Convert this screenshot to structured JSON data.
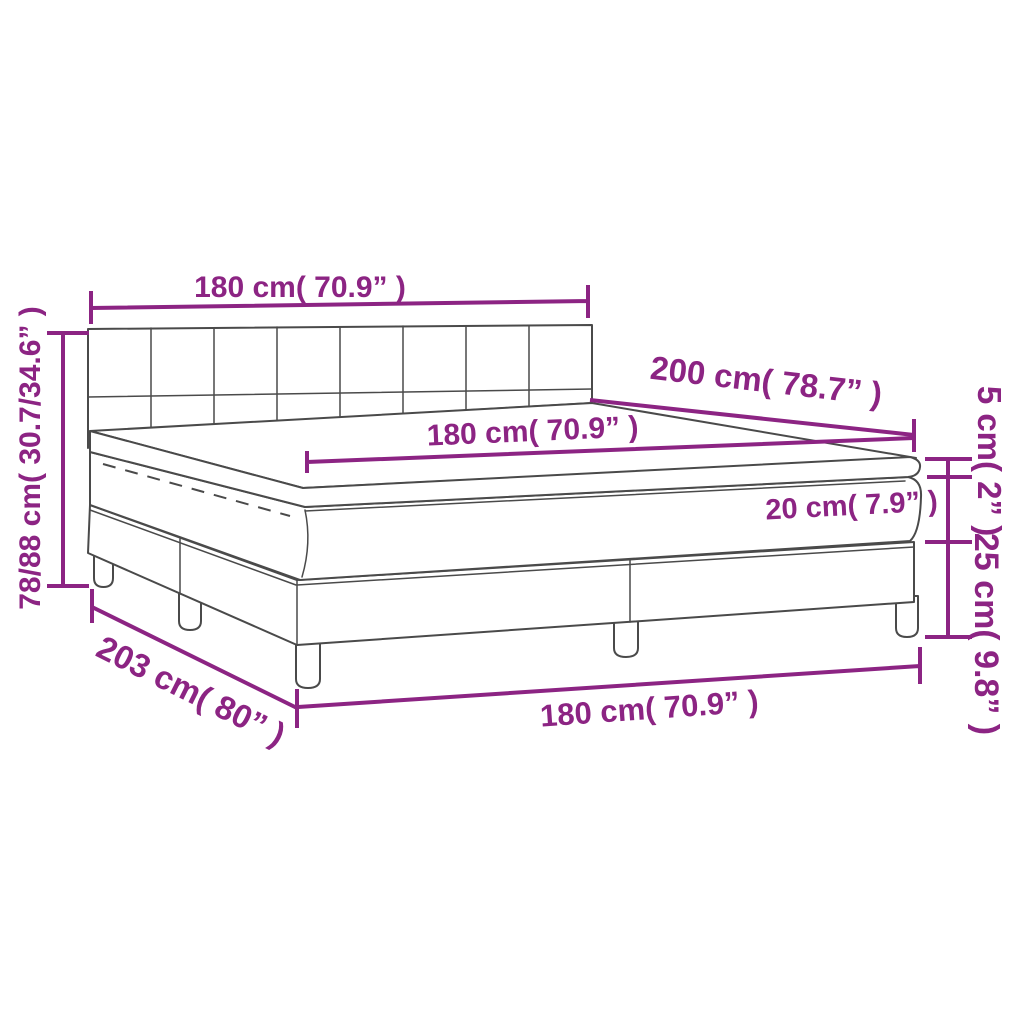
{
  "diagram": {
    "title": "box-spring-bed-dimension-diagram",
    "colors": {
      "dimension": "#8C2483",
      "outline": "#4A4A4A",
      "background": "#FFFFFF"
    },
    "labels": {
      "headboard_width": "180 cm( 70.9” )",
      "overall_height": "78/88 cm( 30.7/34.6” )",
      "length": "200 cm( 78.7” )",
      "mattress_width": "180 cm( 70.9” )",
      "topper_height": "5 cm( 2” )",
      "mattress_height": "20 cm( 7.9” )",
      "base_height": "25 cm( 9.8” )",
      "base_length": "203 cm( 80” )",
      "base_width": "180 cm( 70.9” )"
    }
  }
}
